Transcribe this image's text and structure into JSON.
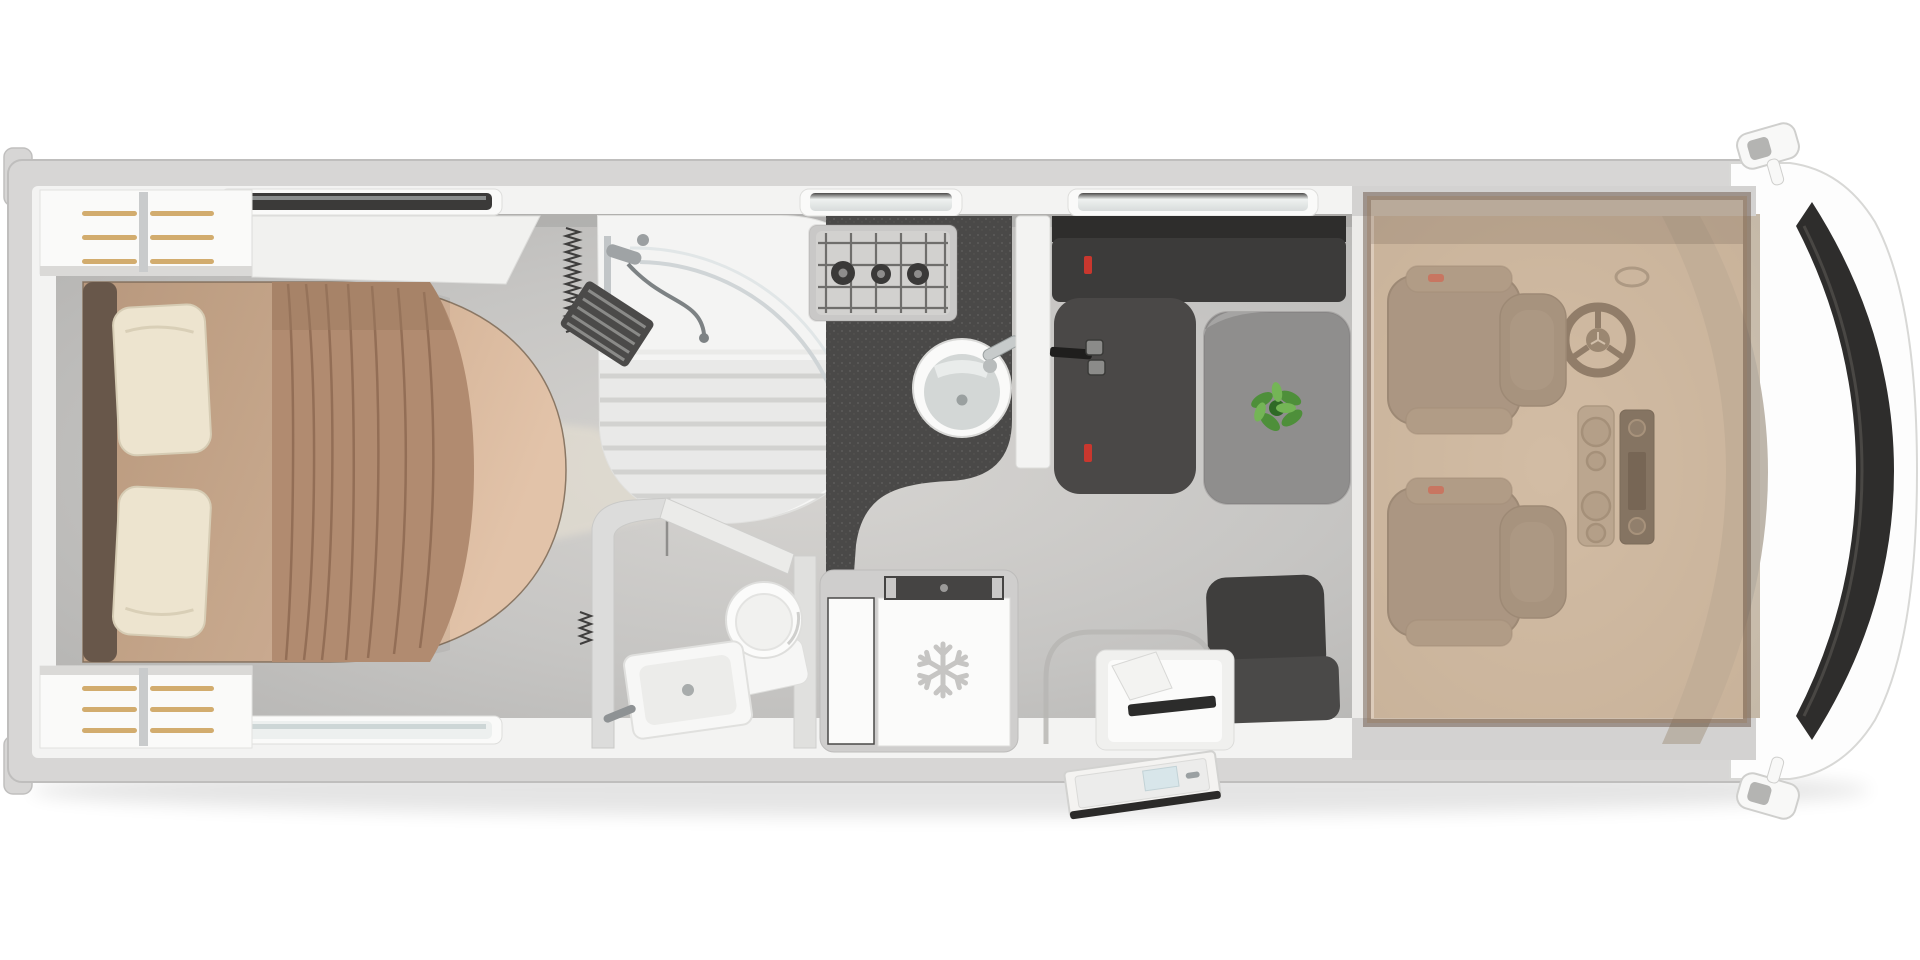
{
  "page": {
    "title": "motorhome-floorplan-top-view",
    "background": "#ffffff"
  },
  "palette": {
    "page_bg": "#ffffff",
    "body_shell": "#d7d6d5",
    "body_outline": "#c0bfbe",
    "nose_white": "#fdfdfd",
    "windshield_dark": "#2e2d2c",
    "wall_white": "#f3f3f2",
    "floor_main": "#c4c3c1",
    "floor_light": "#e9e2d3",
    "window_dark": "#3b3a39",
    "window_glass": "#edf0ef",
    "window_frame": "#fafaf9",
    "wardrobe_white": "#fafaf9",
    "hanger_gold": "#d2ac6e",
    "bed_base": "#cbaa8e",
    "bed_foot": "#dec0a6",
    "bed_bolster": "#6e5c4e",
    "drape": "#b18b70",
    "drape_fold": "#8e6a52",
    "pillow": "#ede4cf",
    "shower_white": "#f6f6f5",
    "shower_tray": "#e9e9e8",
    "fixture_gray": "#9fa3a5",
    "blind_dark": "#3f3e3d",
    "counter_dark": "#4a4948",
    "hob_steel": "#c9c8c7",
    "burner_dark": "#3a3938",
    "sink_rim": "#fafaf9",
    "sink_bowl": "#d3d7d6",
    "sofa_dark": "#3c3b3a",
    "sofa_seat": "#4a4847",
    "table_gray": "#8f8e8d",
    "plant_green": "#4e8f3a",
    "plant_light": "#74b556",
    "plant_dark": "#2f6a26",
    "accent_red": "#c9372e",
    "seat_brown": "#8a8178",
    "seat_trim": "#968c81",
    "dash_gray": "#b7aea2",
    "cab_floor": "#cfc2b2",
    "overlay_tan": "#cbab8c",
    "overlay_border": "#5e4837",
    "fridge_frame": "#cfcecd",
    "fridge_door": "#fbfbfa",
    "fridge_vent": "#454443",
    "snowflake": "#c6c5c3",
    "step_white": "#f0f0ee",
    "door_white": "#f4f3f1",
    "door_edge": "#2b2a29",
    "mirror_white": "#f8f8f7"
  },
  "floorplan": {
    "view": "top-down",
    "vehicle_type": "motorhome",
    "rooms": [
      {
        "id": "bedroom",
        "label": "rear bedroom",
        "fixtures": [
          {
            "name": "island-bed",
            "pillows": 2,
            "drape": true
          },
          {
            "name": "wardrobe-top",
            "hanger_rails": 3
          },
          {
            "name": "wardrobe-bottom",
            "hanger_rails": 3
          },
          {
            "name": "overhead-locker"
          }
        ]
      },
      {
        "id": "bathroom",
        "label": "bathroom",
        "fixtures": [
          {
            "name": "corner-shower",
            "glass_door": true,
            "hand-shower": true
          },
          {
            "name": "washbasin"
          },
          {
            "name": "toilet"
          },
          {
            "name": "concertina-blind",
            "count": 2
          },
          {
            "name": "slatted-mat"
          }
        ]
      },
      {
        "id": "kitchen",
        "label": "kitchen",
        "fixtures": [
          {
            "name": "gas-hob",
            "burners": 3
          },
          {
            "name": "round-sink",
            "faucet": true
          },
          {
            "name": "refrigerator",
            "doors": 2,
            "icon": "snowflake-icon"
          }
        ]
      },
      {
        "id": "dinette",
        "label": "dinette",
        "fixtures": [
          {
            "name": "bench-sofa",
            "seatbelt_buckles": 2,
            "red_belt_clips": 2
          },
          {
            "name": "dining-table"
          },
          {
            "name": "table-plant"
          },
          {
            "name": "side-seat"
          }
        ]
      },
      {
        "id": "entry",
        "label": "entrance",
        "fixtures": [
          {
            "name": "entry-door",
            "state": "open"
          },
          {
            "name": "entry-step"
          },
          {
            "name": "wheel-arch-recess"
          }
        ]
      },
      {
        "id": "cab",
        "label": "driver cab",
        "fixtures": [
          {
            "name": "driver-seat",
            "armrests": 2
          },
          {
            "name": "passenger-seat",
            "armrests": 2
          },
          {
            "name": "steering-wheel"
          },
          {
            "name": "center-console",
            "cup_holders": 4
          },
          {
            "name": "radio-unit"
          },
          {
            "name": "dashboard"
          },
          {
            "name": "windshield"
          },
          {
            "name": "side-mirror",
            "count": 2
          },
          {
            "name": "drop-down-bed-overlay",
            "translucent": true
          }
        ]
      }
    ],
    "openings": {
      "top_windows": 3,
      "bottom_windows": 1,
      "skylights": 2
    }
  }
}
